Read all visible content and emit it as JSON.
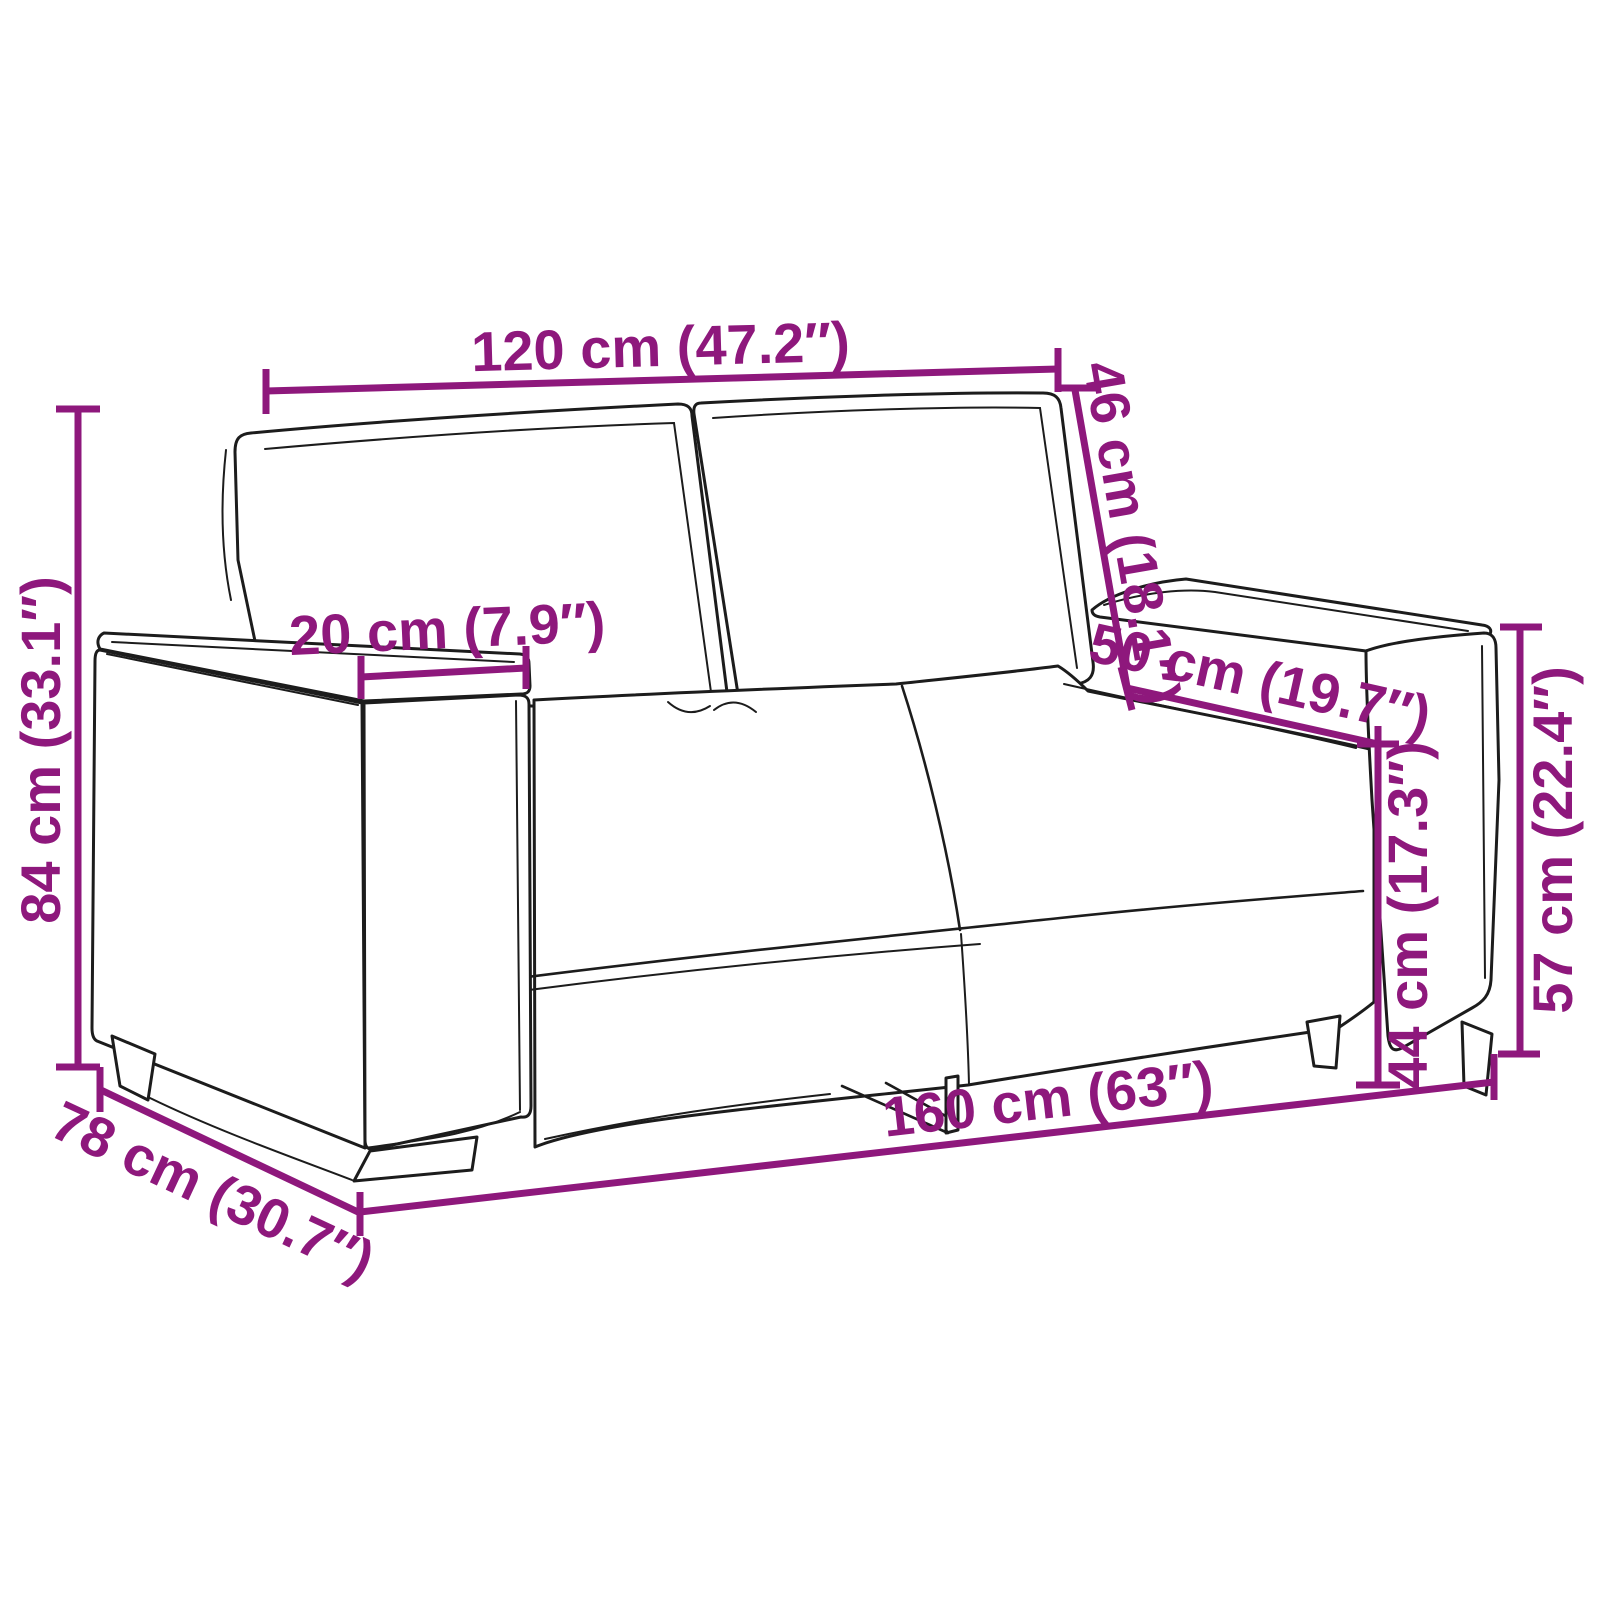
{
  "diagram": {
    "kind": "sofa-dimension-diagram",
    "accent_color": "#8e187c",
    "line_color": "#1c1c1c",
    "background_color": "#ffffff"
  },
  "dims": {
    "back_width": "120 cm (47.2″)",
    "back_cushion_height": "46 cm (18.1″)",
    "armrest_top_width": "20 cm (7.9″)",
    "seat_depth": "50 cm (19.7″)",
    "seat_height": "44 cm (17.3″)",
    "armrest_height": "57 cm (22.4″)",
    "total_height": "84 cm (33.1″)",
    "total_depth": "78 cm (30.7″)",
    "total_width": "160 cm (63″)"
  }
}
